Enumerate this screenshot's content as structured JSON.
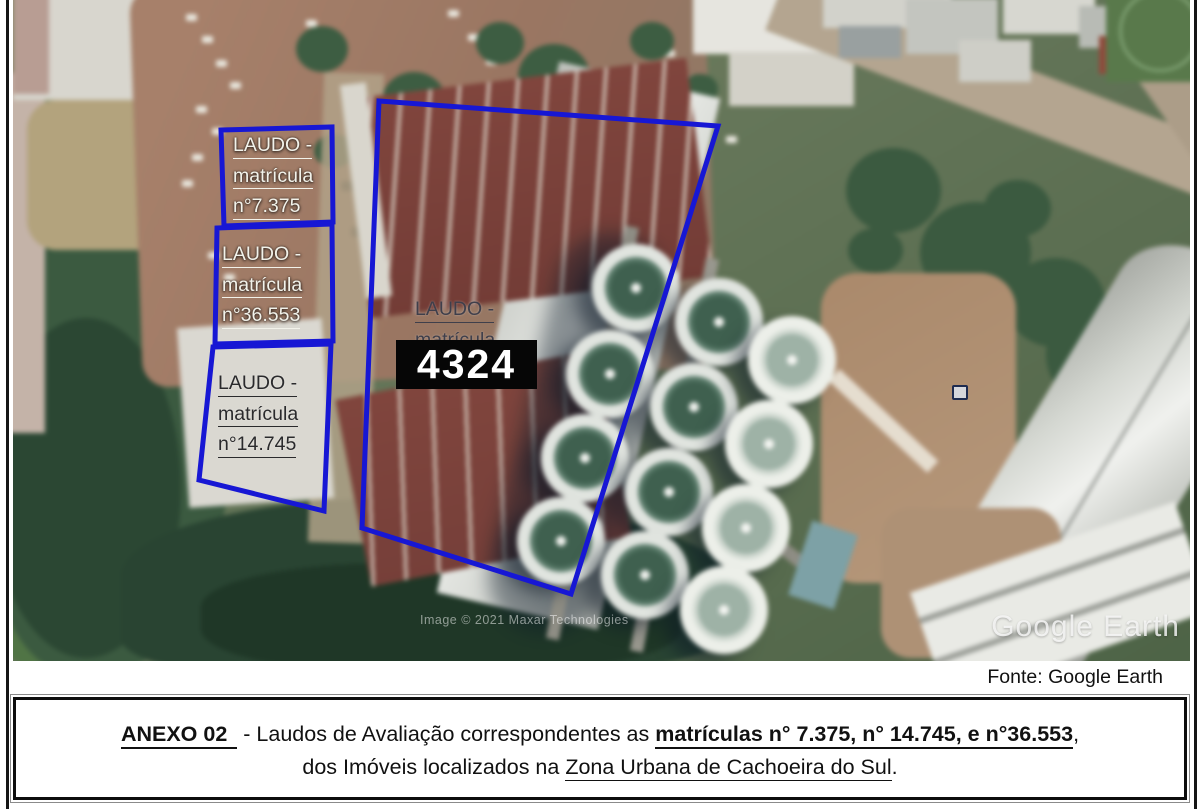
{
  "map_overlay": {
    "outline_color": "#1717d4",
    "parcel_labels": [
      {
        "line1": "LAUDO -",
        "line2": "matrícula",
        "line3": "n°7.375"
      },
      {
        "line1": "LAUDO -",
        "line2": "matrícula",
        "line3": "n°36.553"
      },
      {
        "line1": "LAUDO -",
        "line2": "matrícula",
        "line3": "n°14.745"
      }
    ],
    "center_label": {
      "line1": "LAUDO -",
      "line2": "matrícula"
    },
    "plot_number": "4324"
  },
  "watermarks": {
    "imagery_credit": "Image © 2021 Maxar Technologies",
    "logo": "Google Earth"
  },
  "caption": "Fonte: Google Earth",
  "annex_note": {
    "heading": "ANEXO 02",
    "dash": " - ",
    "body_1": "Laudos de Avaliação correspondentes as ",
    "matriculas_bold": "matrículas n° 7.375, n° 14.745, e n°36.553",
    "comma": ",",
    "line2_normal": "dos Imóveis localizados na ",
    "line2_underlined": "Zona Urbana de Cachoeira do Sul",
    "period": "."
  }
}
